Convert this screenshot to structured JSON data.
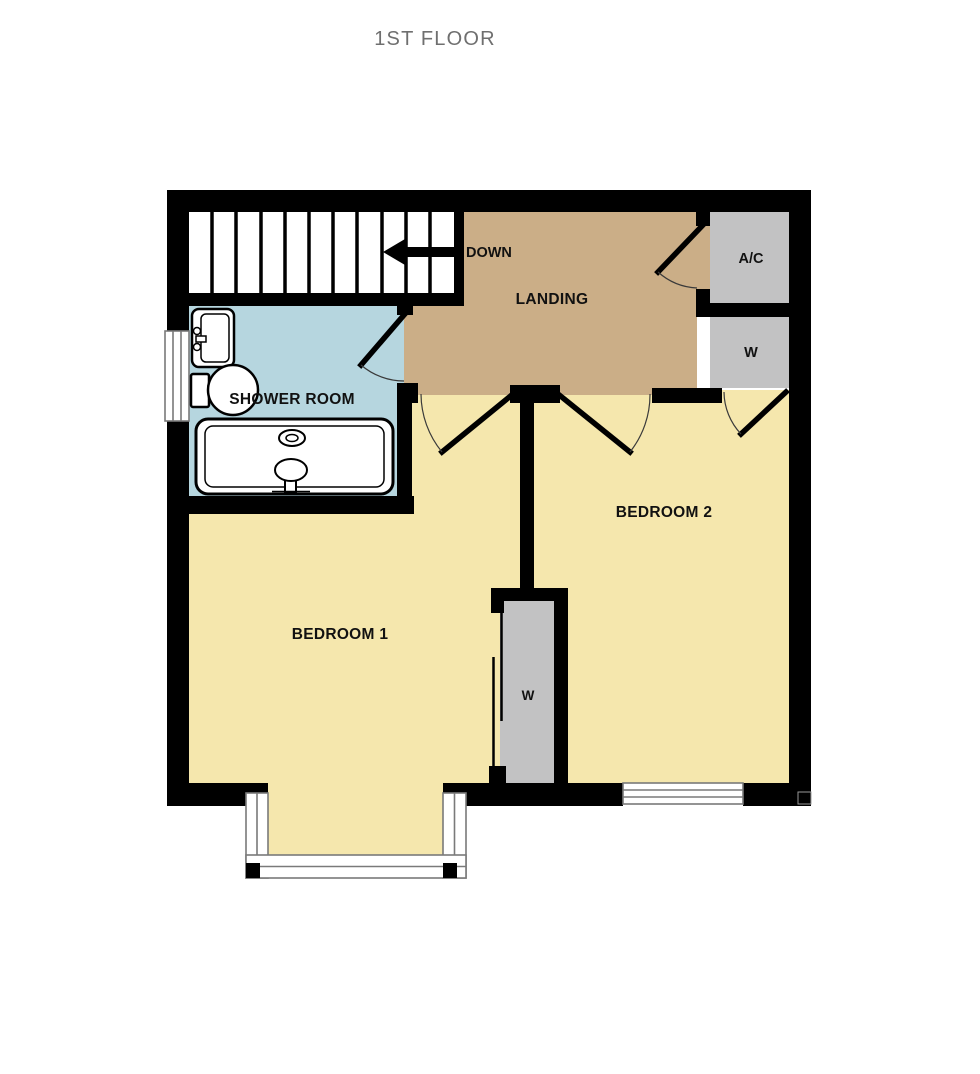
{
  "page": {
    "background": "#ffffff"
  },
  "floor_plan": {
    "title": "1ST FLOOR",
    "colors": {
      "wall": "#000000",
      "bedroom_floor": "#F5E7AD",
      "landing_floor": "#CBAE87",
      "shower_floor": "#B6D6DF",
      "closet_floor": "#C2C2C3",
      "window_frame": "#7a7a7a",
      "title_text": "#6F6F6F",
      "label_text": "#111111"
    },
    "rooms": [
      {
        "name": "landing",
        "label": "LANDING"
      },
      {
        "name": "shower-room",
        "label": "SHOWER ROOM"
      },
      {
        "name": "bedroom-1",
        "label": "BEDROOM 1"
      },
      {
        "name": "bedroom-2",
        "label": "BEDROOM 2"
      },
      {
        "name": "ac-closet",
        "label": "A/C"
      },
      {
        "name": "closet-right",
        "label": "W"
      },
      {
        "name": "closet-middle",
        "label": "W"
      }
    ],
    "stairs": {
      "label": "DOWN",
      "treads": 11,
      "direction": "left"
    },
    "fixtures": [
      "sink",
      "toilet",
      "shower-tray"
    ],
    "windows": 3,
    "doors": 5
  }
}
